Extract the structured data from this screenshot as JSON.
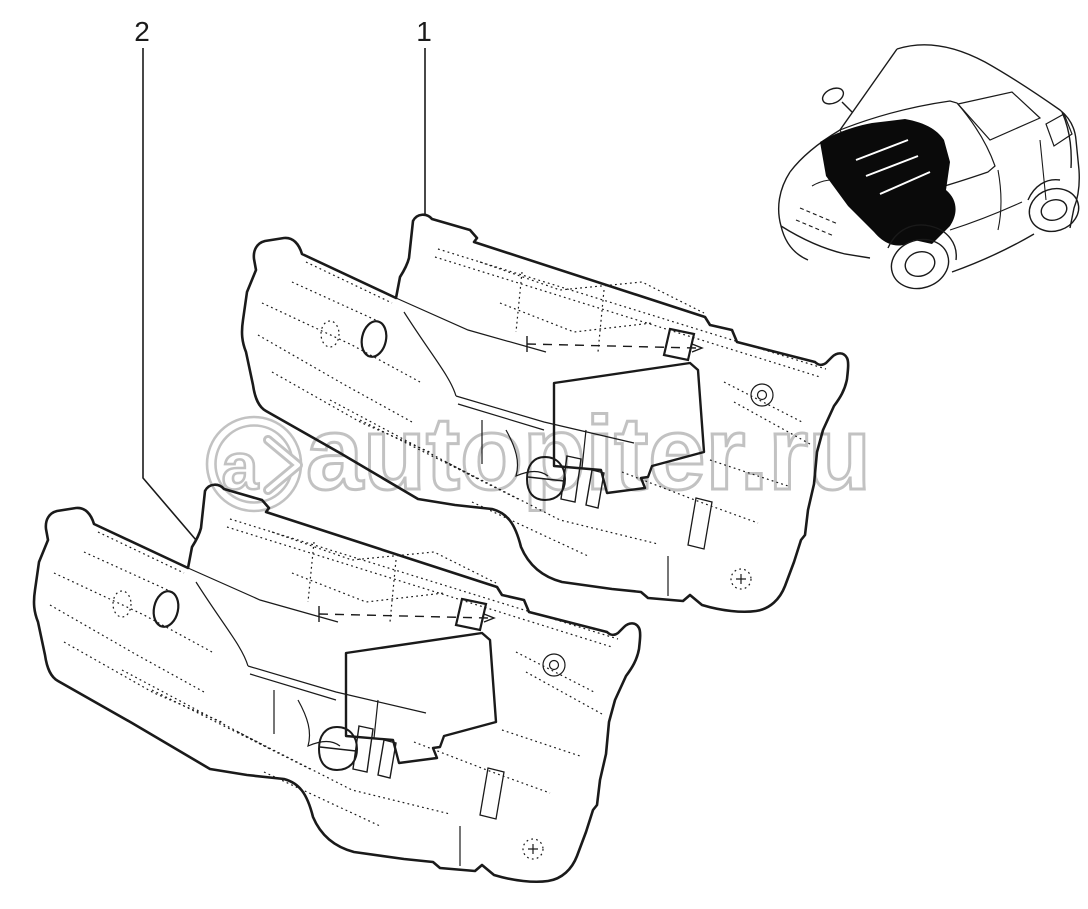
{
  "diagram": {
    "type": "auto-parts-catalog-exploded-view",
    "background_color": "#ffffff",
    "line_color": "#1a1a1a",
    "callouts": [
      {
        "label": "1",
        "x": 424,
        "y": 41,
        "leader": [
          [
            425,
            48
          ],
          [
            425,
            214
          ]
        ],
        "target": "insulator-panel-1"
      },
      {
        "label": "2",
        "x": 142,
        "y": 41,
        "leader": [
          [
            143,
            48
          ],
          [
            143,
            478
          ],
          [
            196,
            540
          ]
        ],
        "target": "insulator-panel-2"
      }
    ],
    "parts": [
      {
        "callout": "1",
        "name": "engine-bay-bulkhead-insulation-panel",
        "offset": {
          "x": 0,
          "y": 0
        }
      },
      {
        "callout": "2",
        "name": "engine-bay-bulkhead-insulation-panel",
        "offset": {
          "x": -208,
          "y": 270
        }
      }
    ],
    "locator": {
      "description": "hatchback-car-front-three-quarter-view",
      "highlight_area": "engine-bay-firewall",
      "highlight_color": "#0a0a0a"
    },
    "watermark": {
      "logo_letter": "a",
      "site_text": "autopiter.ru",
      "color": "#c2c2c2"
    }
  }
}
